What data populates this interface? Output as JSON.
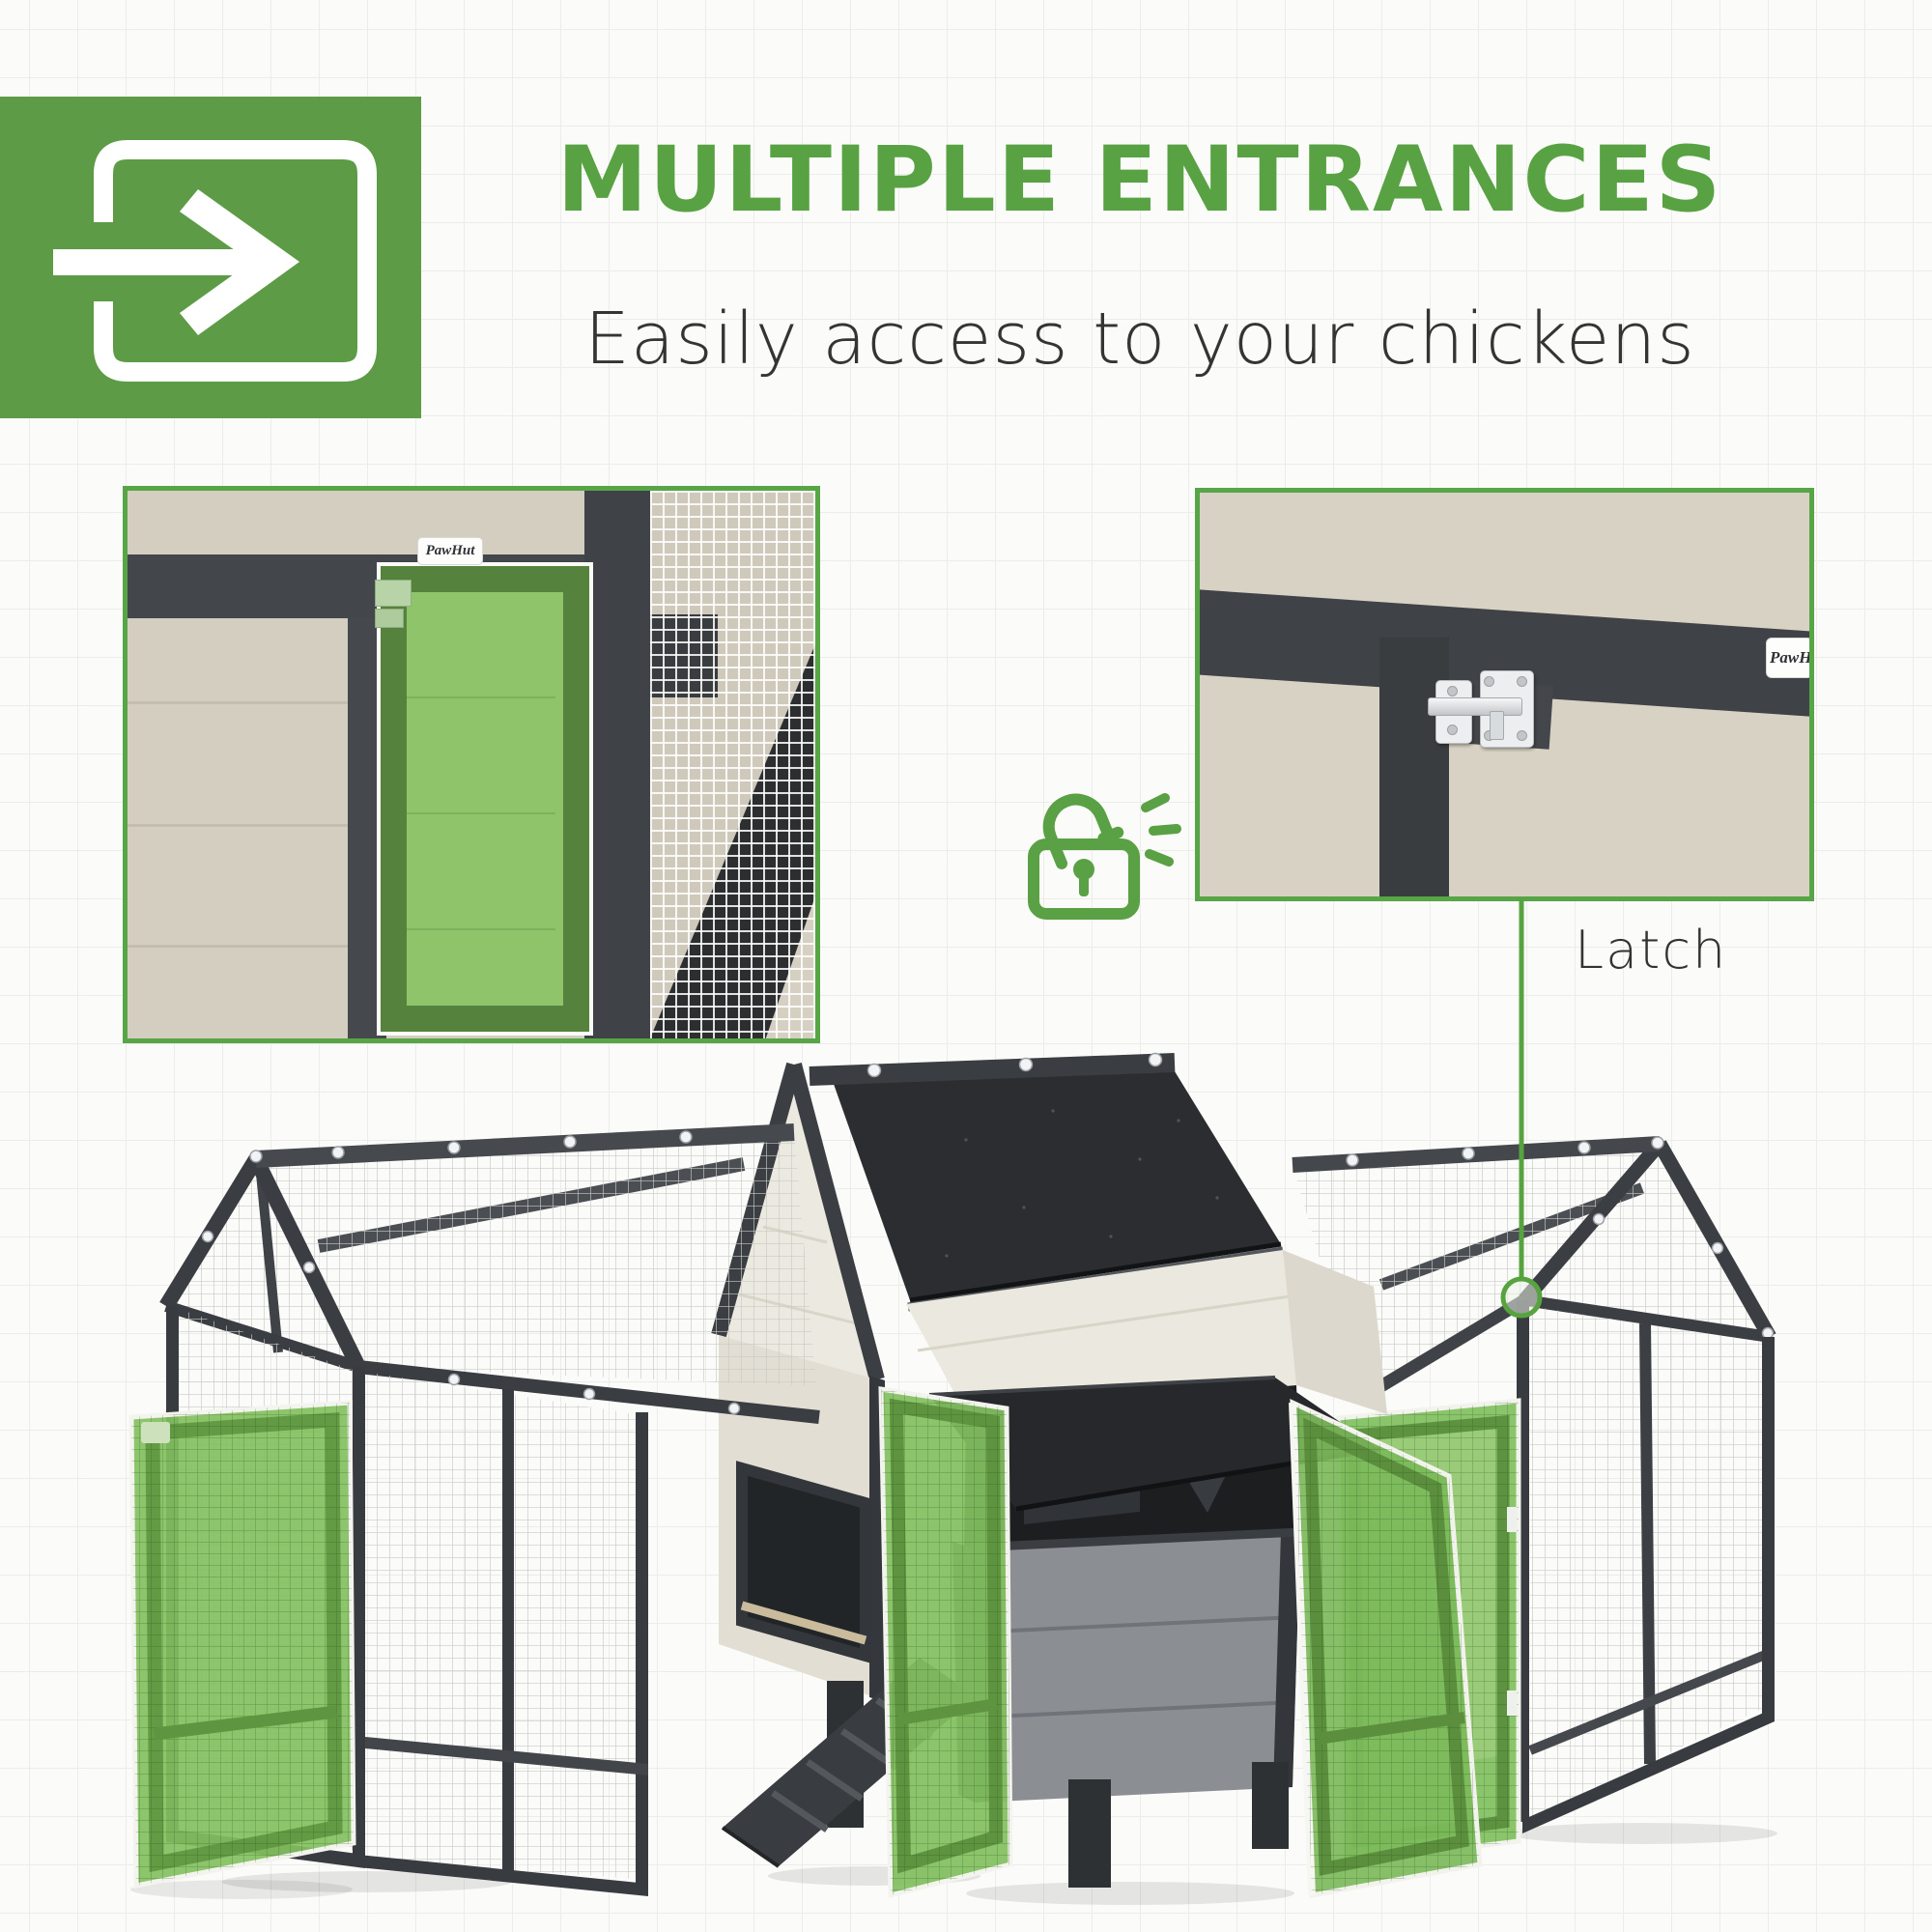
{
  "header": {
    "icon_block": {
      "icon": "enter-arrow-icon",
      "bg": "#5d9b46",
      "glyph_color": "#ffffff"
    },
    "title": {
      "text": "MULTIPLE ENTRANCES",
      "color": "#58a244"
    },
    "subtitle": {
      "text": "Easily access to your chickens",
      "color": "#343434"
    }
  },
  "callouts": {
    "lock_icon": {
      "icon": "unlocked-padlock-icon",
      "color": "#58a244"
    },
    "latch": {
      "label": "Latch",
      "text_color": "#333333",
      "line_color": "#57a33f"
    }
  },
  "insets": {
    "border_color": "#57a546",
    "left": {
      "name": "coop-door-closeup",
      "brand": "PawHut",
      "highlight_color": "#8fc46b"
    },
    "right": {
      "name": "latch-closeup",
      "brand": "PawHut"
    }
  },
  "product": {
    "name": "chicken-coop-render",
    "colors": {
      "frame_dark": "#383b3f",
      "roof": "#2b2d30",
      "wall_cream": "#ebe8df",
      "nest_gray": "#8b8f94",
      "highlight_green": "#7fbe5d",
      "door_frame_green": "#5e9340",
      "mesh_line": "#c9c9c6"
    }
  }
}
